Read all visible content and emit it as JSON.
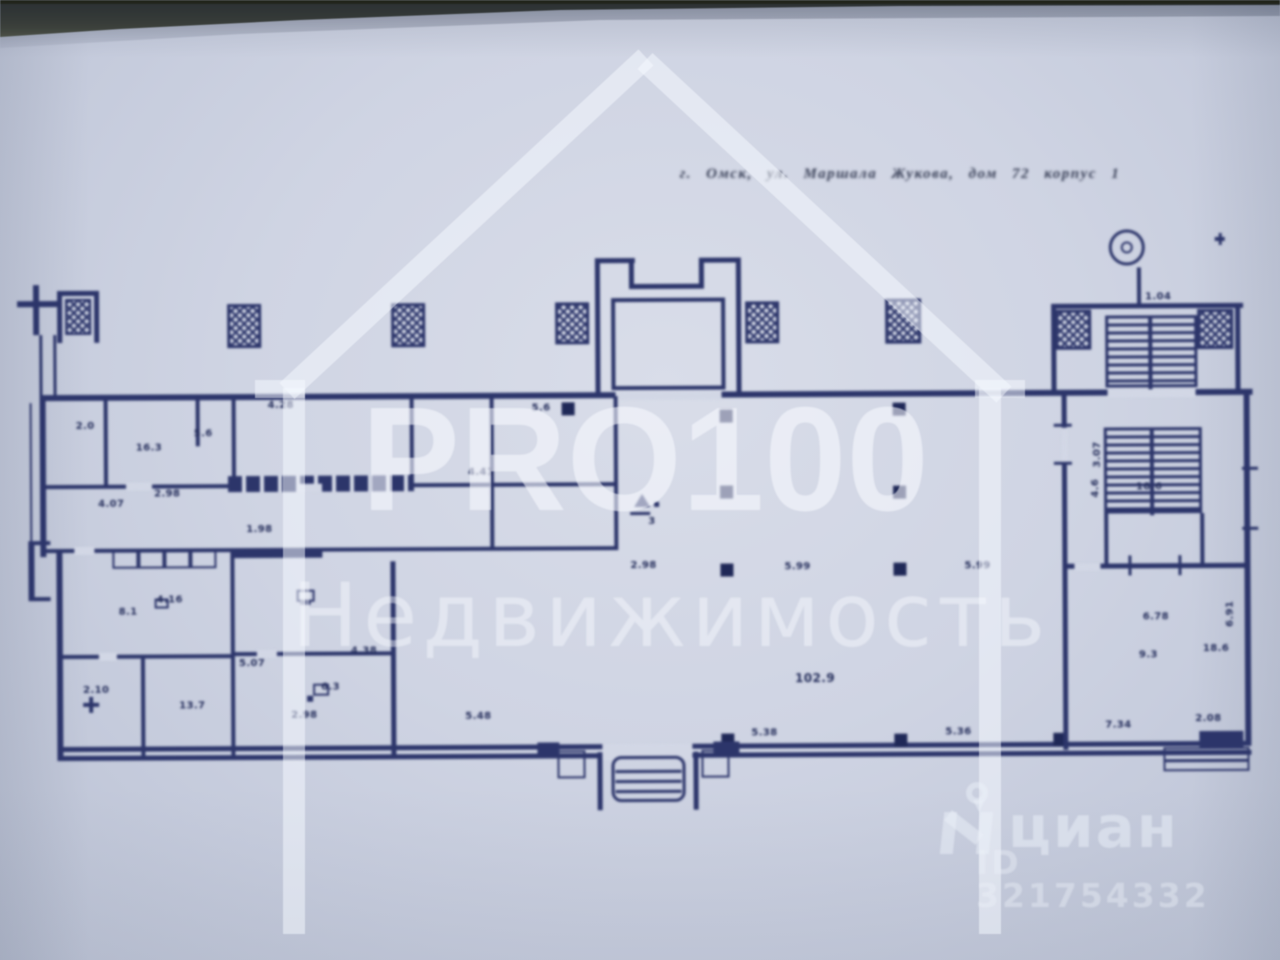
{
  "document": {
    "address_line": "г. Омск, ул. Маршала Жукова, дом 72 корпус 1"
  },
  "watermarks": {
    "brand_top": "PRO100",
    "brand_bottom": "Недвижимость",
    "cian_logo_text": "циан",
    "cian_id_text": "ID 321754332"
  },
  "colors": {
    "ink": "#2c356a",
    "paper": "#cfd4e3",
    "watermark_white": "rgba(248,250,255,0.55)"
  },
  "plan": {
    "annotations": [
      {
        "x": 268,
        "y": 398,
        "t": "4.28"
      },
      {
        "x": 136,
        "y": 440,
        "t": "16.3"
      },
      {
        "x": 76,
        "y": 418,
        "t": "2.0"
      },
      {
        "x": 194,
        "y": 426,
        "t": "5.6"
      },
      {
        "x": 532,
        "y": 402,
        "t": "5.6"
      },
      {
        "x": 468,
        "y": 466,
        "t": "4.41"
      },
      {
        "x": 98,
        "y": 496,
        "t": "4.07"
      },
      {
        "x": 154,
        "y": 486,
        "t": "2.98"
      },
      {
        "x": 246,
        "y": 522,
        "t": "1.98"
      },
      {
        "x": 118,
        "y": 604,
        "t": "8.1"
      },
      {
        "x": 156,
        "y": 592,
        "t": "4.16"
      },
      {
        "x": 82,
        "y": 682,
        "t": "2.10"
      },
      {
        "x": 178,
        "y": 698,
        "t": "13.7"
      },
      {
        "x": 238,
        "y": 656,
        "t": "5.07"
      },
      {
        "x": 320,
        "y": 680,
        "t": "6.3"
      },
      {
        "x": 350,
        "y": 644,
        "t": "4.38"
      },
      {
        "x": 290,
        "y": 708,
        "t": "2.98"
      },
      {
        "x": 464,
        "y": 710,
        "t": "5.48"
      },
      {
        "x": 648,
        "y": 516,
        "t": "3"
      },
      {
        "x": 784,
        "y": 562,
        "t": "5.99"
      },
      {
        "x": 964,
        "y": 562,
        "t": "5.99"
      },
      {
        "x": 630,
        "y": 560,
        "t": "2.98"
      },
      {
        "x": 794,
        "y": 672,
        "t": "102.9",
        "s": 12
      },
      {
        "x": 1136,
        "y": 484,
        "t": "18.6"
      },
      {
        "x": 1090,
        "y": 500,
        "t": "4.6",
        "r": -90
      },
      {
        "x": 1142,
        "y": 614,
        "t": "6.78"
      },
      {
        "x": 1138,
        "y": 652,
        "t": "9.3"
      },
      {
        "x": 1202,
        "y": 646,
        "t": "18.6"
      },
      {
        "x": 1224,
        "y": 630,
        "t": "6.91",
        "r": -90
      },
      {
        "x": 750,
        "y": 728,
        "t": "5.38"
      },
      {
        "x": 944,
        "y": 728,
        "t": "5.36"
      },
      {
        "x": 1104,
        "y": 722,
        "t": "7.34"
      },
      {
        "x": 1194,
        "y": 716,
        "t": "2.08"
      },
      {
        "x": 1146,
        "y": 294,
        "t": "1.04"
      },
      {
        "x": 1092,
        "y": 470,
        "t": "3.07",
        "r": -90
      }
    ]
  }
}
